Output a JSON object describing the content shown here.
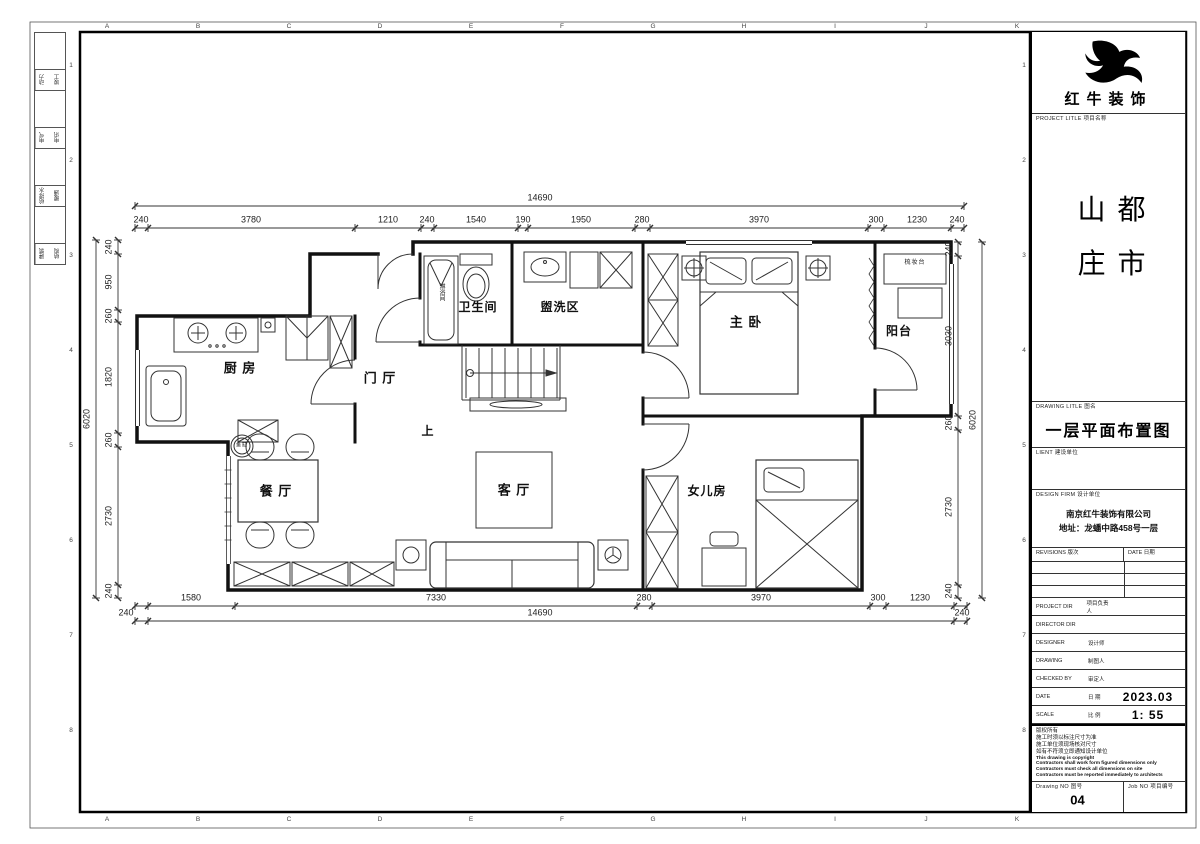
{
  "sheet": {
    "background": "#ffffff",
    "line_color": "#1a1a1a"
  },
  "frame": {
    "top_letters": [
      "A",
      "B",
      "C",
      "D",
      "E",
      "F",
      "G",
      "H",
      "I",
      "J",
      "K"
    ],
    "side_numbers": [
      "1",
      "2",
      "3",
      "4",
      "5",
      "6",
      "7",
      "8"
    ],
    "disciplines": [
      [
        "动力",
        "竣工"
      ],
      [
        "电气",
        "电讯"
      ],
      [
        "给排水",
        "暖通"
      ],
      [
        "建筑",
        "结构"
      ]
    ]
  },
  "title_block": {
    "brand": "红牛装饰",
    "project_label": "PROJECT LITLE  项目名称",
    "project_name": "都市山庄",
    "drawing_label": "DRAWING LITLE  图名",
    "drawing_title": "一层平面布置图",
    "client_label": "LIENT  建设单位",
    "design_firm_label": "DESIGN FIRM  设计单位",
    "design_firm_line1": "南京红牛装饰有限公司",
    "design_firm_line2": "地址：龙蟠中路458号一层",
    "revisions_label": "REVISIONS  版次",
    "rev_date_label": "DATE  日期",
    "rows": [
      {
        "label": "PROJECT DIR",
        "cn": "项目负责人",
        "value": ""
      },
      {
        "label": "DIRECTOR DIR",
        "cn": "",
        "value": ""
      },
      {
        "label": "DESIGNER",
        "cn": "设计师",
        "value": ""
      },
      {
        "label": "DRAWING",
        "cn": "制图人",
        "value": ""
      },
      {
        "label": "CHECKED BY",
        "cn": "审定人",
        "value": ""
      },
      {
        "label": "DATE",
        "cn": "日  期",
        "value": "2023.03"
      },
      {
        "label": "SCALE",
        "cn": "比  例",
        "value": "1: 55"
      }
    ],
    "notes": [
      "版权所有",
      "施工时须以标注尺寸为准",
      "施工单位须现场核对尺寸",
      "如有不符须立即通知设计单位",
      "This drawing is copyright",
      "Contractors shall work form figured dimensions only",
      "Contractors must check all dimensions on site",
      "Contractors must be reported immediately to architects"
    ],
    "drawing_no_label": "Drawing NO  图号",
    "drawing_no": "04",
    "job_no_label": "Job NO  项目编号",
    "job_no": ""
  },
  "plan": {
    "labels": [
      {
        "t": "厨 房",
        "x": 240,
        "y": 368,
        "fs": 13
      },
      {
        "t": "门 厅",
        "x": 380,
        "y": 378,
        "fs": 13
      },
      {
        "t": "卫生间",
        "x": 478,
        "y": 307,
        "fs": 12
      },
      {
        "t": "盥洗区",
        "x": 560,
        "y": 307,
        "fs": 12
      },
      {
        "t": "主 卧",
        "x": 746,
        "y": 322,
        "fs": 13
      },
      {
        "t": "阳台",
        "x": 899,
        "y": 331,
        "fs": 12
      },
      {
        "t": "餐 厅",
        "x": 276,
        "y": 491,
        "fs": 13
      },
      {
        "t": "客 厅",
        "x": 514,
        "y": 490,
        "fs": 13
      },
      {
        "t": "女儿房",
        "x": 707,
        "y": 491,
        "fs": 12
      },
      {
        "t": "上",
        "x": 428,
        "y": 431,
        "fs": 12
      },
      {
        "t": "淋浴间",
        "x": 441,
        "y": 292,
        "fs": 6,
        "vert": true
      },
      {
        "t": "梳妆台",
        "x": 915,
        "y": 263,
        "fs": 6
      },
      {
        "t": "鱼缸",
        "x": 242,
        "y": 446,
        "fs": 5
      }
    ],
    "dim_rows": [
      {
        "orient": "h",
        "line": 228,
        "from": 135,
        "to": 964,
        "ticks": [
          135,
          148,
          355,
          421,
          434,
          518,
          528,
          635,
          650,
          868,
          884,
          951,
          964
        ],
        "labels": [
          [
            "240",
            141
          ],
          [
            "3780",
            251
          ],
          [
            "1210",
            388
          ],
          [
            "240",
            427
          ],
          [
            "1540",
            476
          ],
          [
            "190",
            523
          ],
          [
            "1950",
            581
          ],
          [
            "280",
            642
          ],
          [
            "3970",
            759
          ],
          [
            "300",
            876
          ],
          [
            "1230",
            917
          ],
          [
            "240",
            957
          ]
        ]
      },
      {
        "orient": "h",
        "line": 206,
        "from": 135,
        "to": 964,
        "ticks": [
          135,
          964
        ],
        "labels": [
          [
            "14690",
            540
          ]
        ]
      },
      {
        "orient": "h",
        "line": 606,
        "from": 135,
        "to": 967,
        "ticks": [
          135,
          148,
          235,
          637,
          652,
          870,
          886,
          954,
          967
        ],
        "labels": [
          [
            "1580",
            191
          ],
          [
            "7330",
            436
          ],
          [
            "280",
            644
          ],
          [
            "3970",
            761
          ],
          [
            "300",
            878
          ],
          [
            "1230",
            920
          ]
        ]
      },
      {
        "orient": "h",
        "line": 621,
        "from": 135,
        "to": 967,
        "ticks": [
          135,
          148,
          954,
          967
        ],
        "labels": [
          [
            "240",
            126
          ],
          [
            "14690",
            540
          ],
          [
            "240",
            962
          ]
        ]
      },
      {
        "orient": "v",
        "line": 118,
        "from": 240,
        "to": 598,
        "ticks": [
          240,
          254,
          310,
          322,
          433,
          447,
          585,
          598
        ],
        "labels": [
          [
            "240",
            247
          ],
          [
            "950",
            282
          ],
          [
            "260",
            316
          ],
          [
            "1820",
            377
          ],
          [
            "260",
            440
          ],
          [
            "2730",
            516
          ],
          [
            "240",
            591
          ]
        ]
      },
      {
        "orient": "v",
        "line": 96,
        "from": 240,
        "to": 598,
        "ticks": [
          240,
          598
        ],
        "labels": [
          [
            "6020",
            419
          ]
        ]
      },
      {
        "orient": "v",
        "line": 958,
        "from": 242,
        "to": 598,
        "ticks": [
          242,
          256,
          416,
          430,
          585,
          598
        ],
        "labels": [
          [
            "240",
            249
          ],
          [
            "3030",
            336
          ],
          [
            "260",
            423
          ],
          [
            "2730",
            507
          ],
          [
            "240",
            591
          ]
        ]
      },
      {
        "orient": "v",
        "line": 982,
        "from": 242,
        "to": 598,
        "ticks": [
          242,
          598
        ],
        "labels": [
          [
            "6020",
            420
          ]
        ]
      }
    ]
  }
}
